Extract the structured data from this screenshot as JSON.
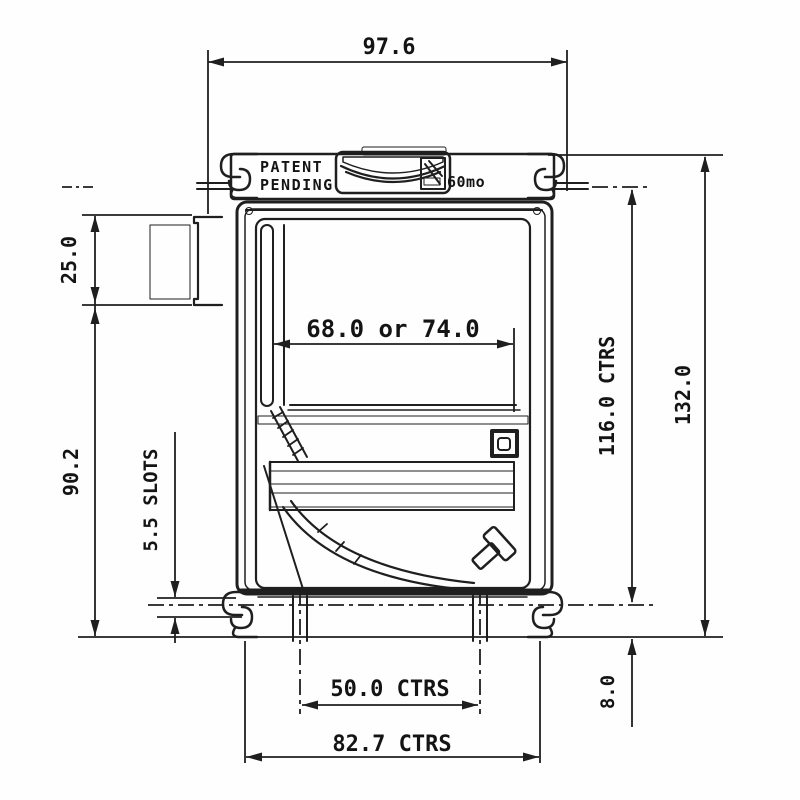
{
  "drawing": {
    "device_markings": {
      "patent_line1": "PATENT",
      "patent_line2": "PENDING",
      "logo_text": "60mo"
    },
    "dimensions": {
      "overall_width": "97.6",
      "connector_height": "25.0",
      "body_height": "90.2",
      "slot_size": "5.5 SLOTS",
      "paper_width": "68.0 or 74.0",
      "mounting_centres_vertical": "116.0 CTRS",
      "overall_height": "132.0",
      "slot_offset_bottom": "8.0",
      "slot_centres_horizontal": "50.0 CTRS",
      "outer_centres_horizontal": "82.7 CTRS"
    }
  }
}
